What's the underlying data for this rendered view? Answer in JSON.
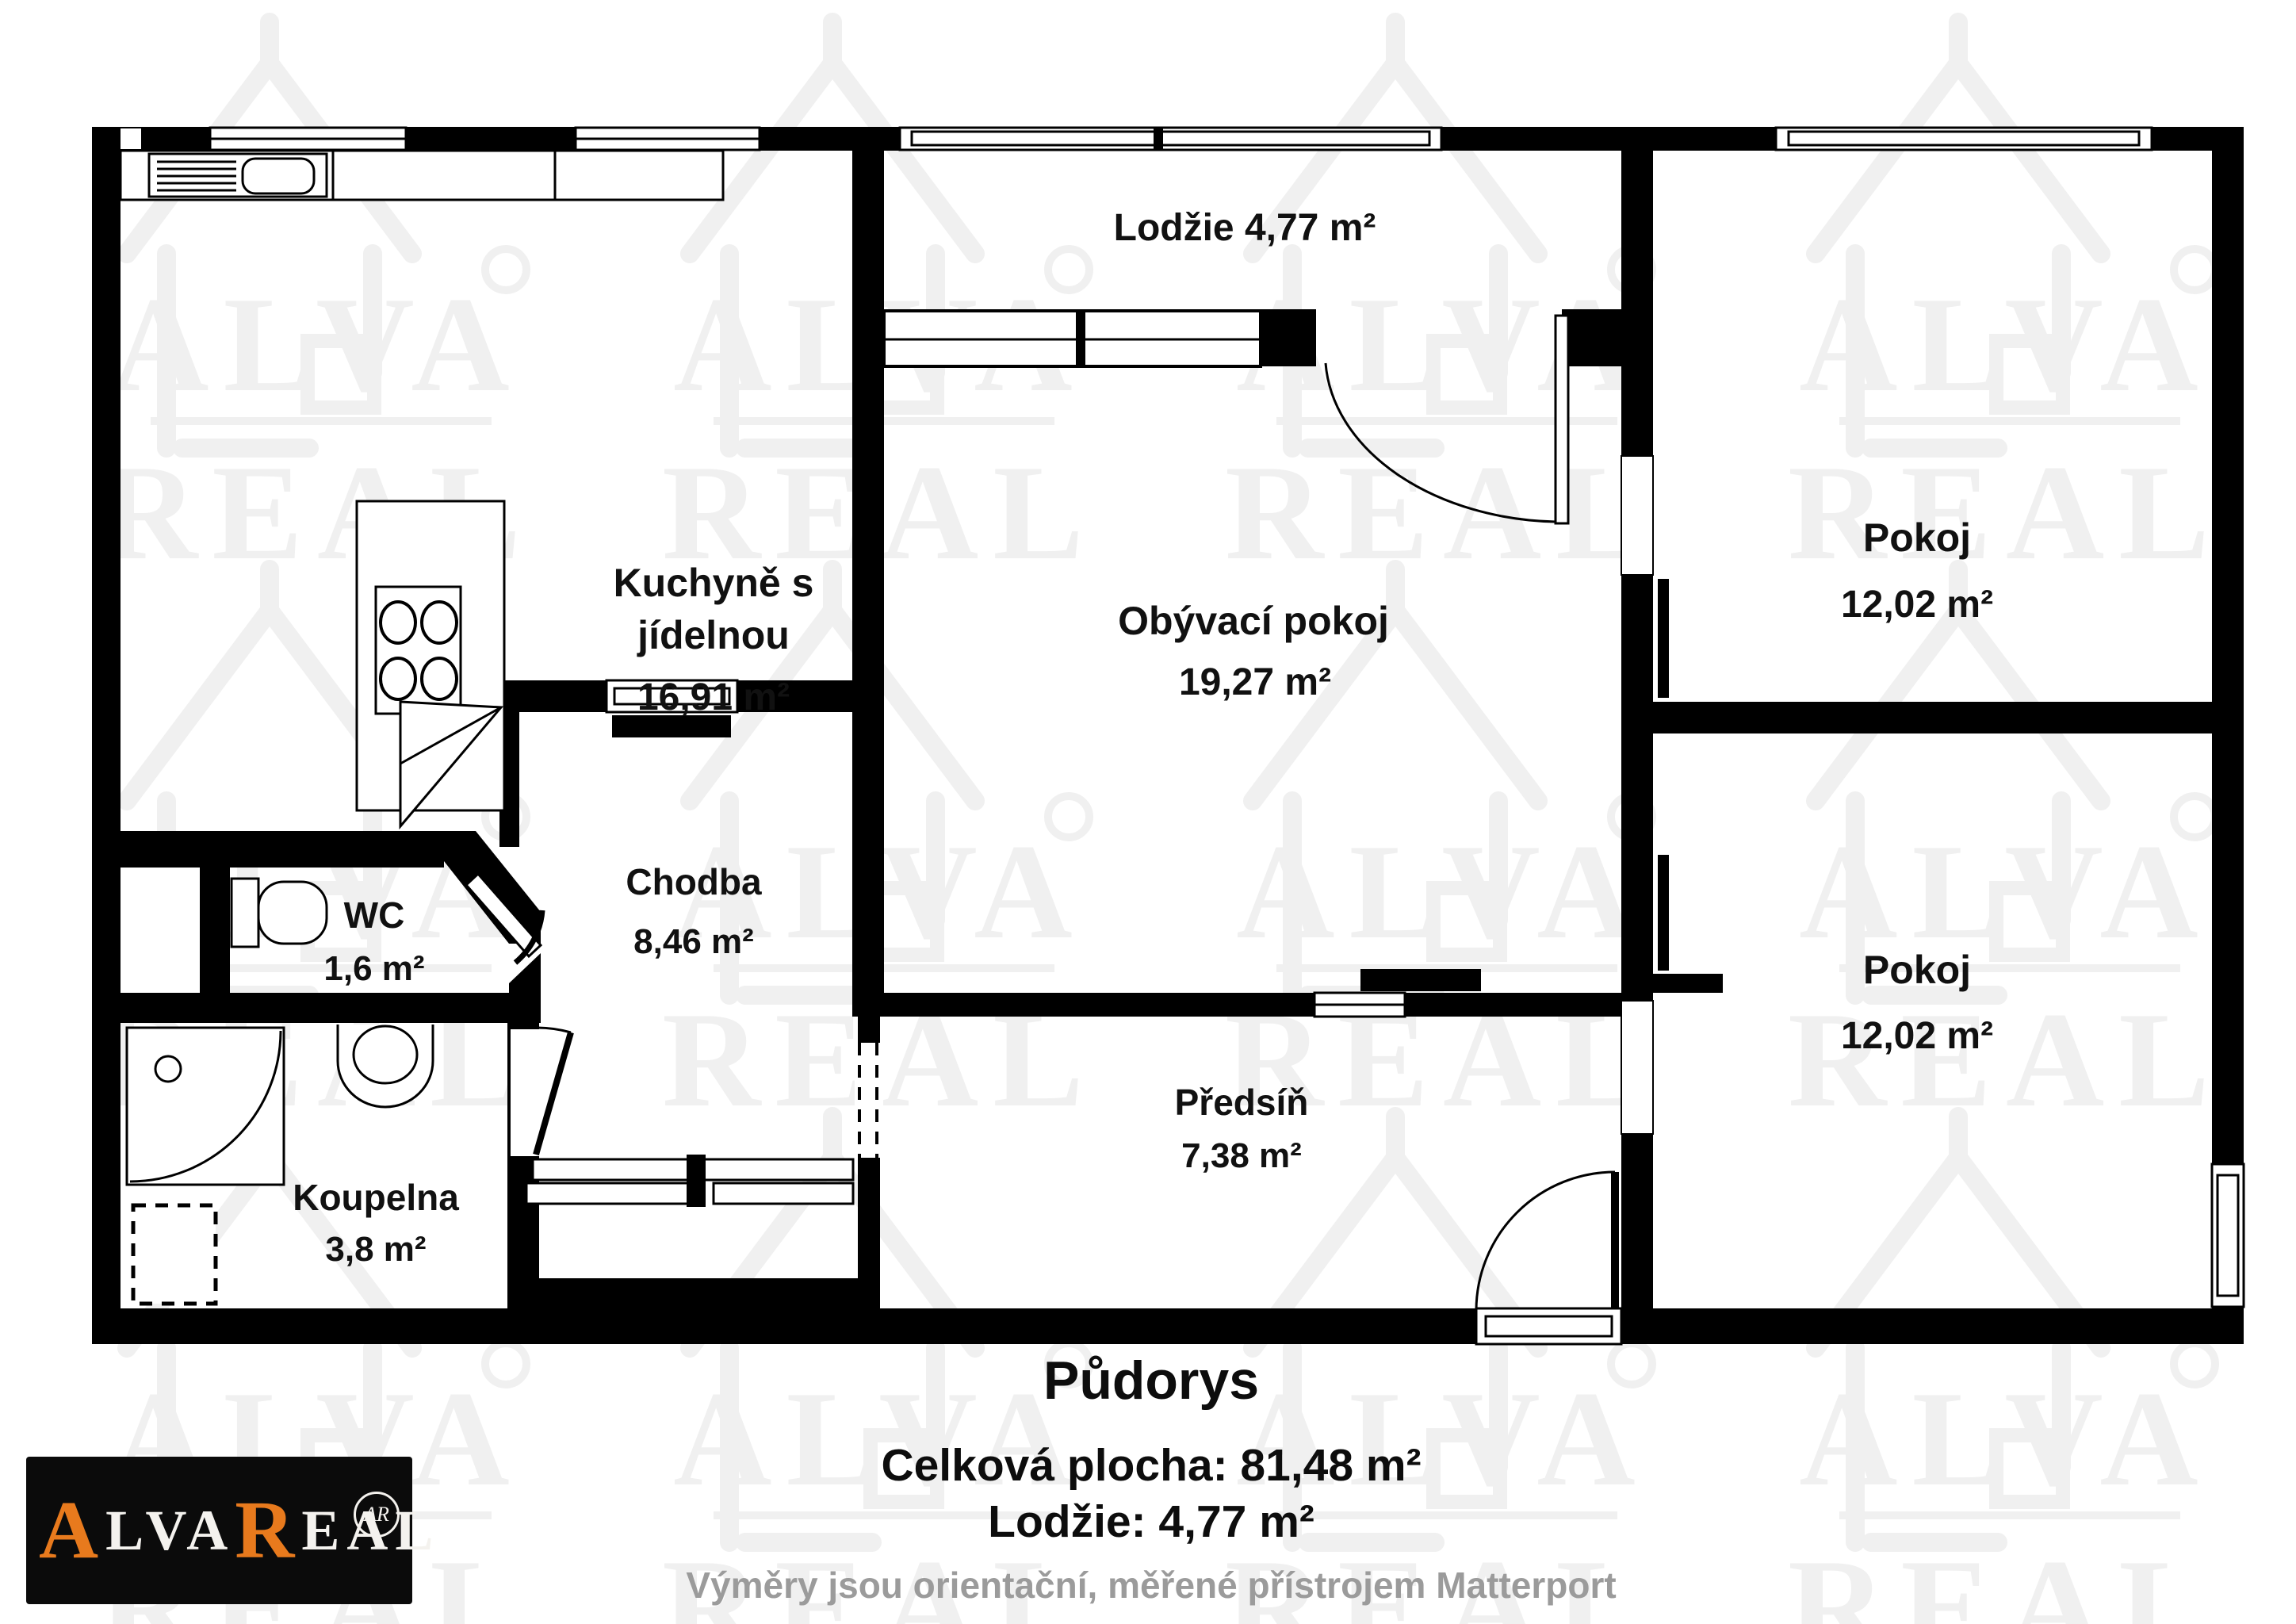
{
  "document": {
    "kind": "apartment floor plan"
  },
  "watermark": {
    "line1": "ALVA",
    "line2": "REAL"
  },
  "rooms": {
    "lodzie": {
      "label": "Lodžie 4,77 m²"
    },
    "kuchyne": {
      "line1": "Kuchyně s",
      "line2": "jídelnou",
      "area": "16,91 m²"
    },
    "obyvaci": {
      "name": "Obývací pokoj",
      "area": "19,27 m²"
    },
    "pokoj1": {
      "name": "Pokoj",
      "area": "12,02 m²"
    },
    "pokoj2": {
      "name": "Pokoj",
      "area": "12,02 m²"
    },
    "chodba": {
      "name": "Chodba",
      "area": "8,46 m²"
    },
    "wc": {
      "name": "WC",
      "area": "1,6 m²"
    },
    "koupelna": {
      "name": "Koupelna",
      "area": "3,8 m²"
    },
    "predsin": {
      "name": "Předsíň",
      "area": "7,38 m²"
    }
  },
  "footer": {
    "title": "Půdorys",
    "total": "Celková plocha: 81,48 m²",
    "lodzie": "Lodžie: 4,77 m²",
    "note": "Výměry jsou orientační, měřené přístrojem Matterport"
  },
  "logo": {
    "word1_initial": "A",
    "word1_rest": "LVA",
    "word2_initial": "R",
    "word2_rest": "EAL",
    "monogram": "AR"
  },
  "colors": {
    "wall": "#000000",
    "accent_orange": "#e87a1d",
    "note_gray": "#9b9b9b"
  }
}
